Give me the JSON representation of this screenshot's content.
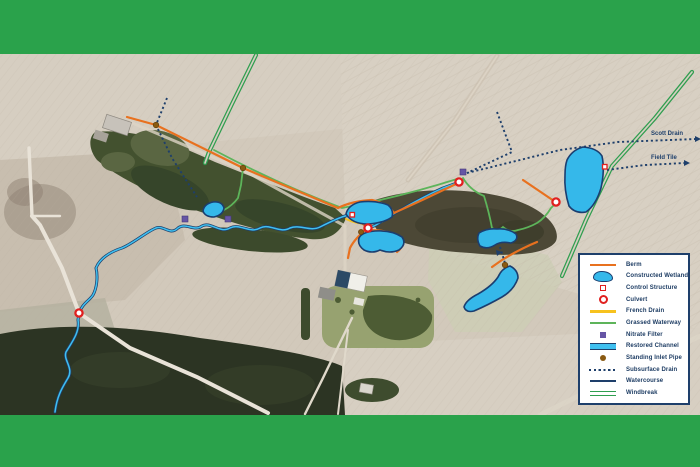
{
  "window": {
    "width": 700,
    "height": 467,
    "description": "Aerial map of farm drainage and wetland restoration features with legend"
  },
  "frame": {
    "band_color": "#2aa24b"
  },
  "map": {
    "labels": {
      "scott_drain": "Scott Drain",
      "field_tile": "Field Tile"
    }
  },
  "legend": {
    "items": [
      {
        "label": "Berm",
        "type": "berm",
        "color": "#e8711f"
      },
      {
        "label": "Constructed Wetland",
        "type": "constructed-wetland",
        "color": "#35b8ea"
      },
      {
        "label": "Control Structure",
        "type": "control-structure",
        "color": "#e0201f"
      },
      {
        "label": "Culvert",
        "type": "culvert",
        "color": "#e0201f"
      },
      {
        "label": "French Drain",
        "type": "french-drain",
        "color": "#f7c21e"
      },
      {
        "label": "Grassed Waterway",
        "type": "grassed-waterway",
        "color": "#5db45a"
      },
      {
        "label": "Nitrate Filter",
        "type": "nitrate-filter",
        "color": "#6655a5"
      },
      {
        "label": "Restored Channel",
        "type": "restored-channel",
        "color": "#3fc0f0"
      },
      {
        "label": "Standing Inlet Pipe",
        "type": "standing-inlet-pipe",
        "color": "#8a5a12"
      },
      {
        "label": "Subsurface Drain",
        "type": "subsurface-drain",
        "color": "#1e3f6b"
      },
      {
        "label": "Watercourse",
        "type": "watercourse",
        "color": "#1e3f6b"
      },
      {
        "label": "Windbreak",
        "type": "windbreak",
        "color": "#2f9e4f"
      }
    ]
  },
  "colors": {
    "band": "#2aa24b",
    "berm": "#e8711f",
    "wetland-fill": "#35b8ea",
    "wetland-stroke": "#1b3e70",
    "red": "#e0201f",
    "yellow": "#f7c21e",
    "green": "#5db45a",
    "purple": "#6655a5",
    "cyan": "#3fc0f0",
    "brown": "#8a5a12",
    "navy": "#1e3f6b",
    "windbreak": "#2f9e4f",
    "legend-text": "#1d3c63"
  }
}
